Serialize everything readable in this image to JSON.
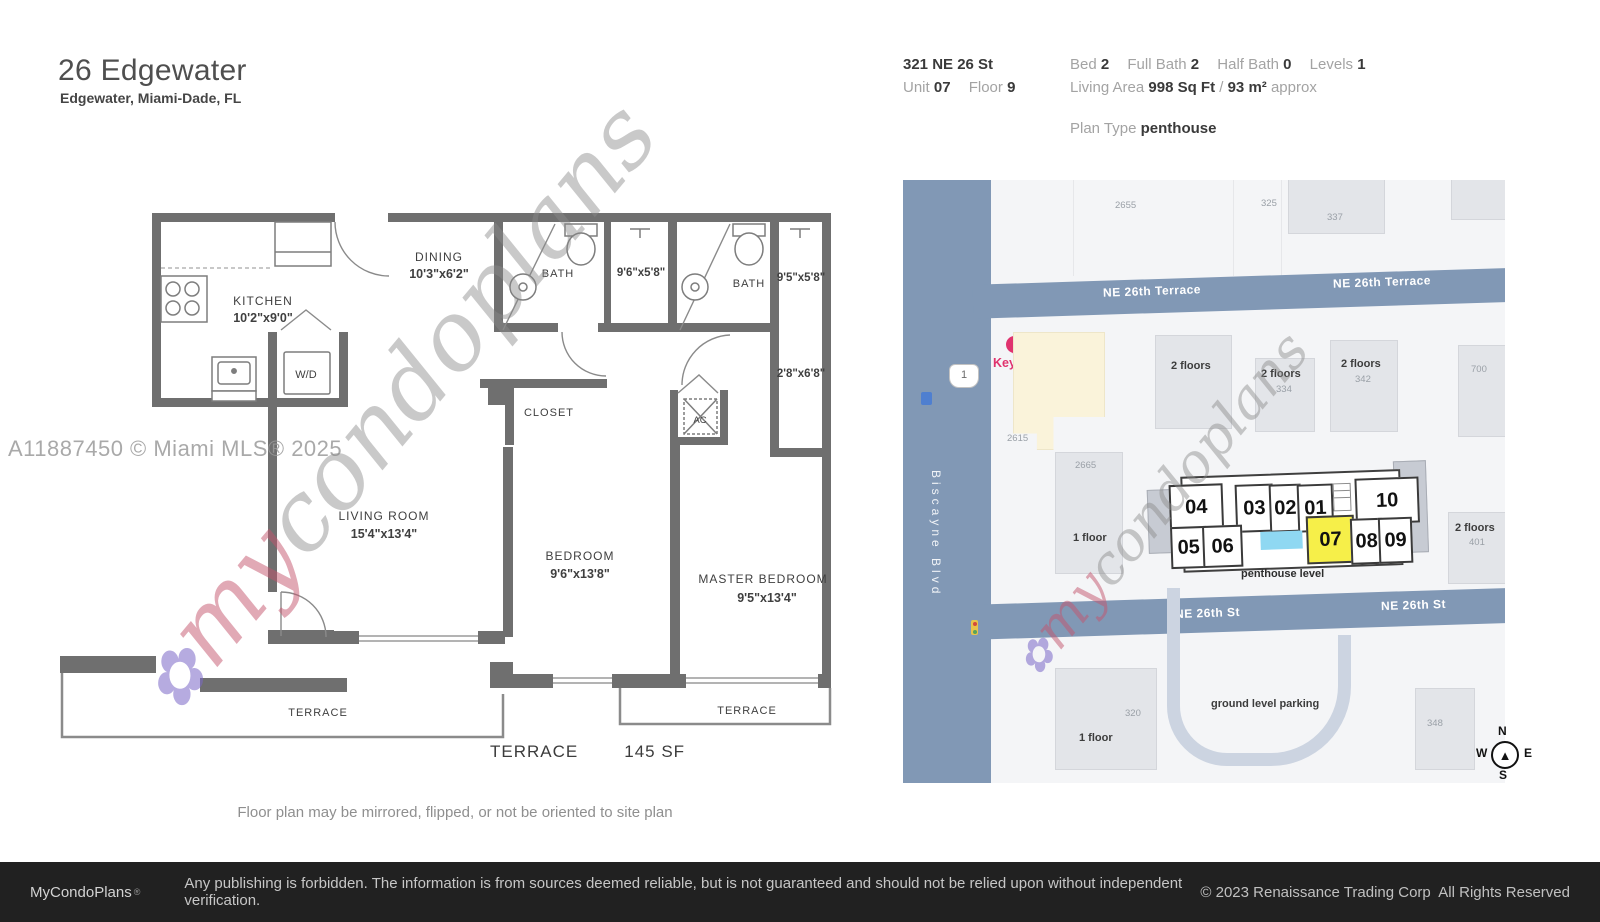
{
  "header": {
    "title": "26 Edgewater",
    "subtitle": "Edgewater, Miami-Dade, FL"
  },
  "info": {
    "address": "321 NE 26 St",
    "unit_label": "Unit",
    "unit_value": "07",
    "floor_label": "Floor",
    "floor_value": "9",
    "bed_label": "Bed",
    "bed_value": "2",
    "full_bath_label": "Full Bath",
    "full_bath_value": "2",
    "half_bath_label": "Half Bath",
    "half_bath_value": "0",
    "levels_label": "Levels",
    "levels_value": "1",
    "living_label": "Living Area",
    "living_value": "998 Sq Ft",
    "living_sep": "/",
    "living_metric": "93 m²",
    "living_approx": "approx",
    "plan_type_label": "Plan Type",
    "plan_type_value": "penthouse"
  },
  "watermark": {
    "mls": "A11887450 © Miami MLS® 2025",
    "flower": "✿",
    "my": "my",
    "rest": "condoplans"
  },
  "plan": {
    "kitchen": {
      "name": "KITCHEN",
      "dims": "10'2\"x9'0\""
    },
    "dining": {
      "name": "DINING",
      "dims": "10'3\"x6'2\""
    },
    "bath1": {
      "name": "BATH"
    },
    "shower1": {
      "dims": "9'6\"x5'8\""
    },
    "bath2": {
      "name": "BATH"
    },
    "shower2": {
      "dims": "9'5\"x5'8\""
    },
    "closet_small": {
      "dims": "2'8\"x6'8\""
    },
    "closet": {
      "name": "CLOSET"
    },
    "wd": {
      "name": "W/D"
    },
    "ac": {
      "name": "AC"
    },
    "living": {
      "name": "LIVING ROOM",
      "dims": "15'4\"x13'4\""
    },
    "bedroom": {
      "name": "BEDROOM",
      "dims": "9'6\"x13'8\""
    },
    "master": {
      "name": "MASTER BEDROOM",
      "dims": "9'5\"x13'4\""
    },
    "terrace_left": "TERRACE",
    "terrace_right": "TERRACE",
    "caption": {
      "label": "TERRACE",
      "size": "145 SF"
    },
    "note": "Floor plan may be mirrored, flipped, or not be oriented to site plan"
  },
  "map": {
    "streets": {
      "terrace_a": "NE 26th Terrace",
      "terrace_b": "NE 26th Terrace",
      "st_a": "NE 26th St",
      "st_b": "NE 26th St",
      "blvd": "Biscayne Blvd"
    },
    "shield": "1",
    "poi": {
      "name": "Key west"
    },
    "labels": {
      "b2655": "2655",
      "b325": "325",
      "b337": "337",
      "b2615": "2615",
      "b2665": "2665",
      "b334": "334",
      "b342": "342",
      "b700": "700",
      "b401": "401",
      "b320": "320",
      "b348": "348",
      "floors2": "2 floors",
      "floor1": "1 floor",
      "parking": "ground level parking"
    },
    "site": {
      "u04": "04",
      "u03": "03",
      "u02": "02",
      "u01": "01",
      "u10": "10",
      "u05": "05",
      "u06": "06",
      "u07": "07",
      "u08": "08",
      "u09": "09",
      "level": "penthouse level",
      "highlighted_unit": "07"
    },
    "compass": {
      "n": "N",
      "w": "W",
      "e": "E",
      "s": "S"
    }
  },
  "footer": {
    "brand": "MyCondoPlans",
    "reg": "®",
    "disclaimer": "Any publishing is forbidden. The information is from sources deemed reliable, but is not guaranteed and should not be relied upon without independent verification.",
    "copyright": "© 2023 Renaissance Trading Corp  All Rights Reserved"
  },
  "colors": {
    "road": "#8198b5",
    "highlight_yellow": "#f6ef49",
    "pool_blue": "#8fd8f2",
    "poi_pink": "#e0336e",
    "wall_gray": "#6f6f6f",
    "footer_bg": "#212121"
  }
}
